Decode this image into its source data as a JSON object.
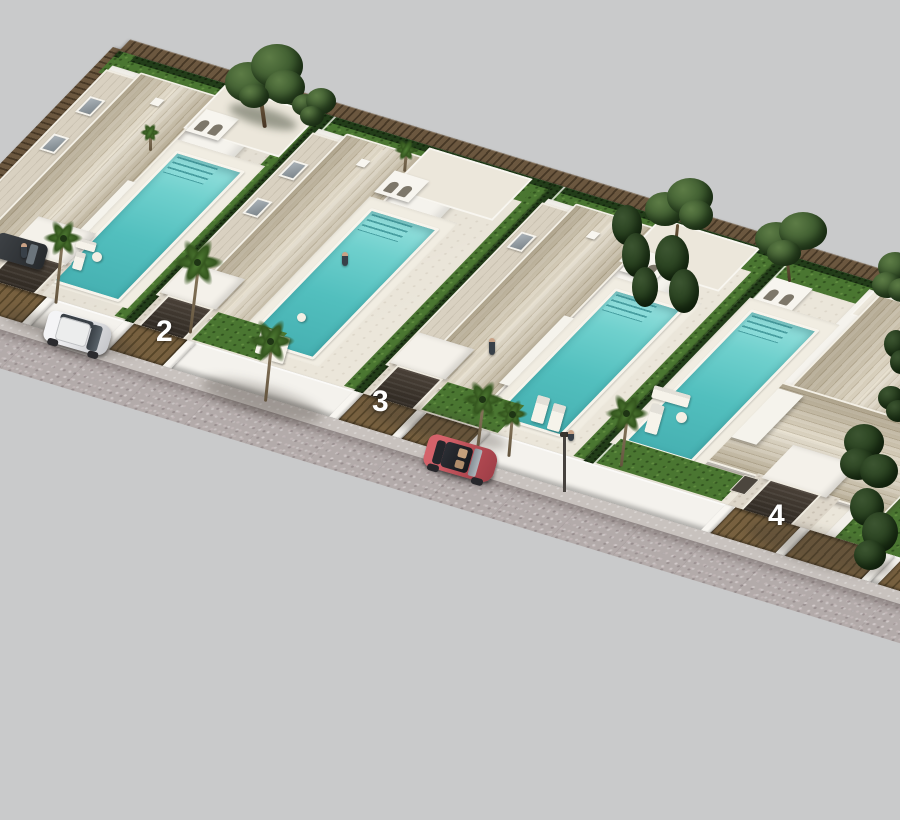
{
  "scene": {
    "title": "New-build villa development - aerial 3D render",
    "view": "aerial oblique bird's-eye",
    "background_color": "#c9cacb",
    "street_surface": "grey cobblestone street along the plot fronts",
    "lot_count_visible": 4
  },
  "development": {
    "villas": [
      {
        "id": "villa-1",
        "street_number": "",
        "position": "far left, partially cropped",
        "features": [
          "tiled hip roof",
          "private pool",
          "open garage",
          "palm trees",
          "patio lounge set",
          "dark car parked in driveway"
        ]
      },
      {
        "id": "villa-2",
        "street_number": "2",
        "position": "second from left",
        "features": [
          "tiled hip roof",
          "private pool with steps",
          "arched porch",
          "timber garage gate",
          "palm tree",
          "sun loungers"
        ]
      },
      {
        "id": "villa-3",
        "street_number": "3",
        "position": "third from left",
        "features": [
          "tiled hip roof",
          "private pool with steps",
          "arched porch",
          "timber garage gate",
          "two palm trees",
          "sun loungers"
        ]
      },
      {
        "id": "villa-4",
        "street_number": "4",
        "position": "front right, largest plot",
        "features": [
          "large tiled hip roof",
          "private pool",
          "timber garage gate",
          "corner garden with pine trees",
          "outdoor sofa set"
        ]
      }
    ],
    "boundary": {
      "rear_fence": "dark timber slat fence",
      "front_fence": "white wall with timber gates and white pillars",
      "hedges": "dark green hedges between plots"
    }
  },
  "street": {
    "vehicles": [
      {
        "name": "silver-suv",
        "color": "#e9e9eb",
        "state": "parked at kerb, far left"
      },
      {
        "name": "red-hatchback",
        "color": "#b85158",
        "state": "on street, centre"
      },
      {
        "name": "dark-car",
        "color": "#34383c",
        "state": "parked in villa-1 driveway"
      }
    ],
    "fixtures": [
      "street lamp"
    ]
  },
  "labels": {
    "plot_numbers": [
      "2",
      "3",
      "4"
    ],
    "label_color": "#ffffff"
  },
  "palette": {
    "roof_tile": "#c9bfa8",
    "villa_wall": "#f5f3ed",
    "pool_water": "#5ec7c5",
    "grass": "#4a7631",
    "hedge": "#223d19",
    "timber_fence": "#6b573f",
    "cobblestone": "#b3abaa",
    "terrace": "#ebe6da"
  }
}
